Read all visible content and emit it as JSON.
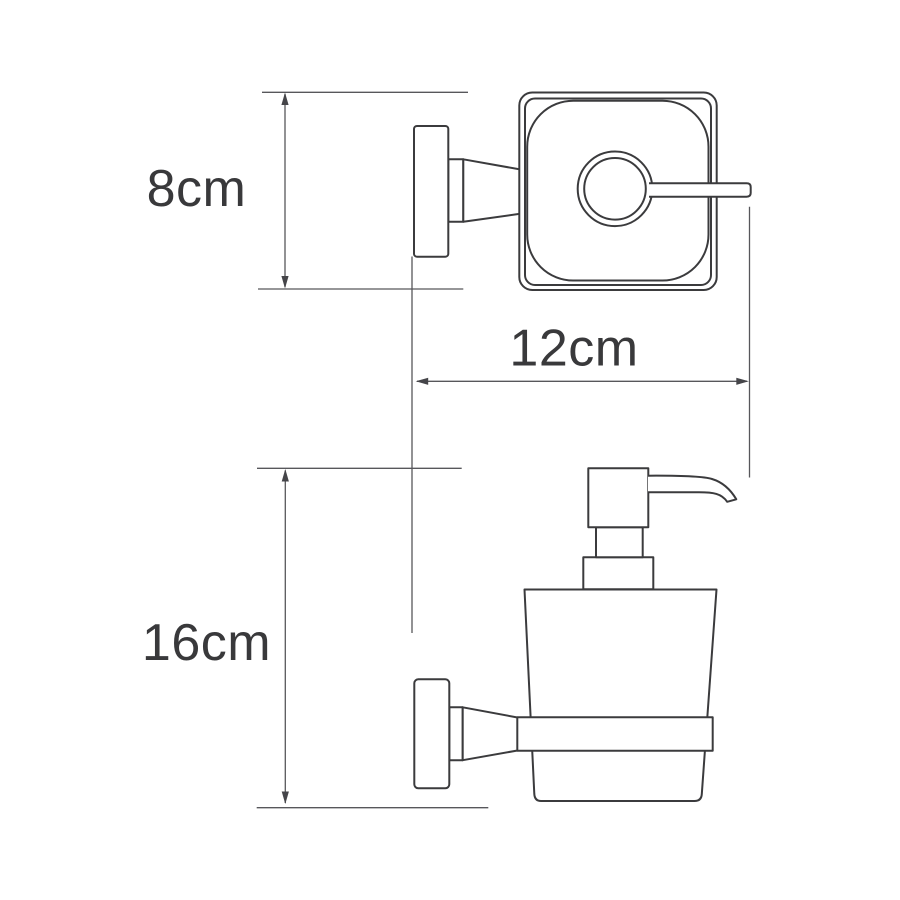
{
  "drawing": {
    "dimensions": {
      "depth": {
        "label": "8cm"
      },
      "width": {
        "label": "12cm"
      },
      "height": {
        "label": "16cm"
      }
    },
    "colors": {
      "outline": "#3b3b3d",
      "dimension_line": "#57575b",
      "text": "#39393b",
      "background": "#ffffff"
    }
  }
}
